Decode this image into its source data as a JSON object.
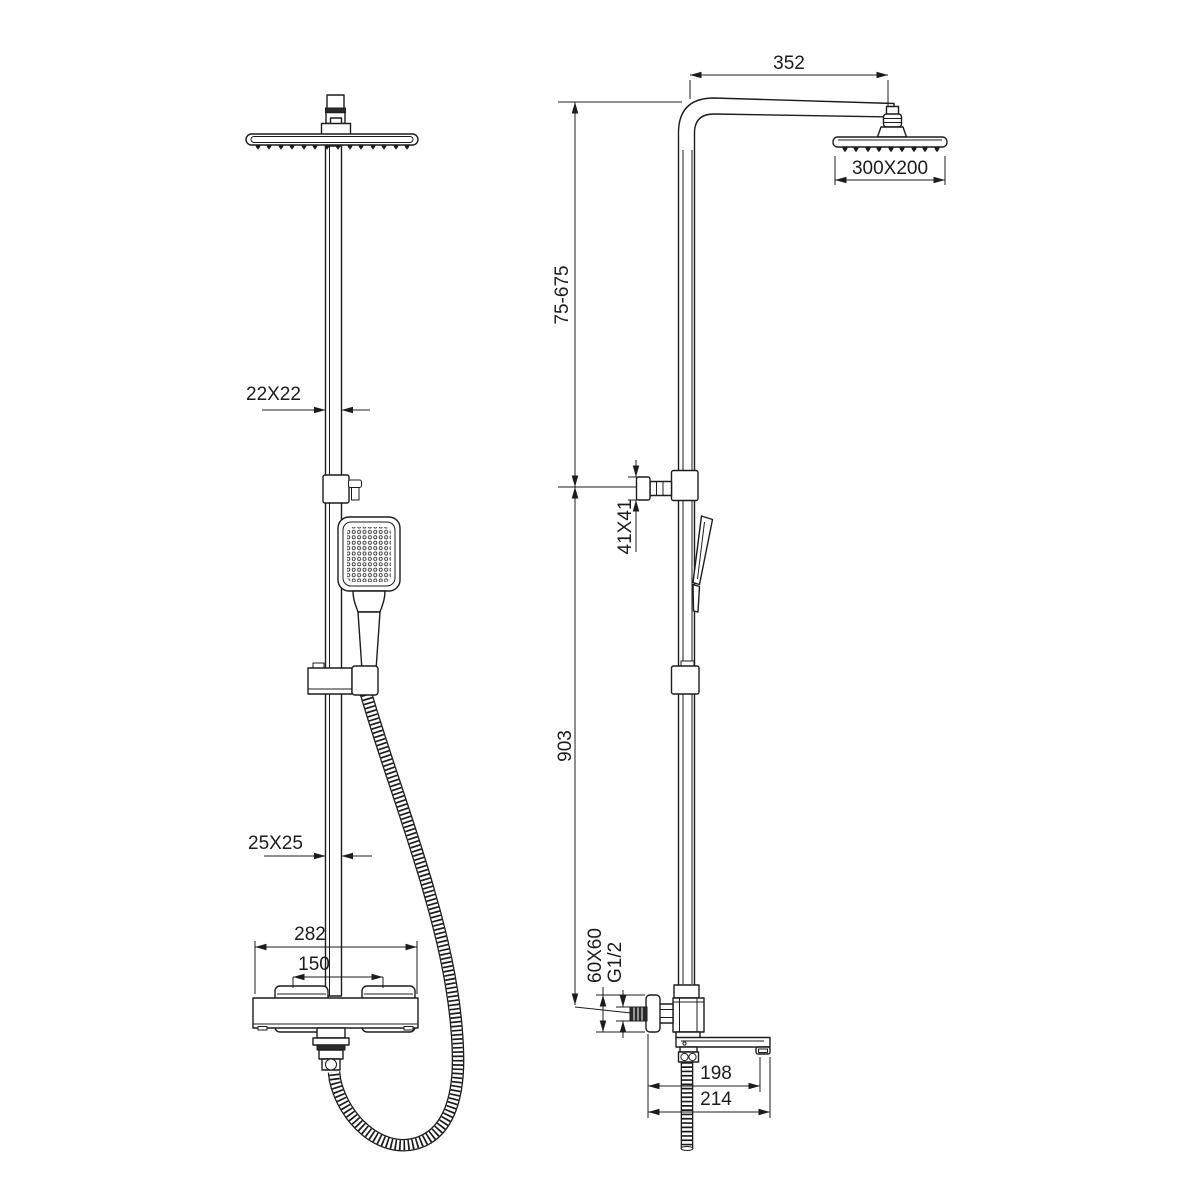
{
  "canvas": {
    "width": 1200,
    "height": 1200,
    "background": "#ffffff",
    "line_color": "#1c1c1c"
  },
  "dims": {
    "d352": "352",
    "d300x200": "300X200",
    "d75_675": "75-675",
    "d22x22": "22X22",
    "d41x41": "41X41",
    "d903": "903",
    "d25x25": "25X25",
    "d282": "282",
    "d150": "150",
    "d60x60": "60X60",
    "dg12": "G1/2",
    "d198": "198",
    "d214": "214"
  }
}
